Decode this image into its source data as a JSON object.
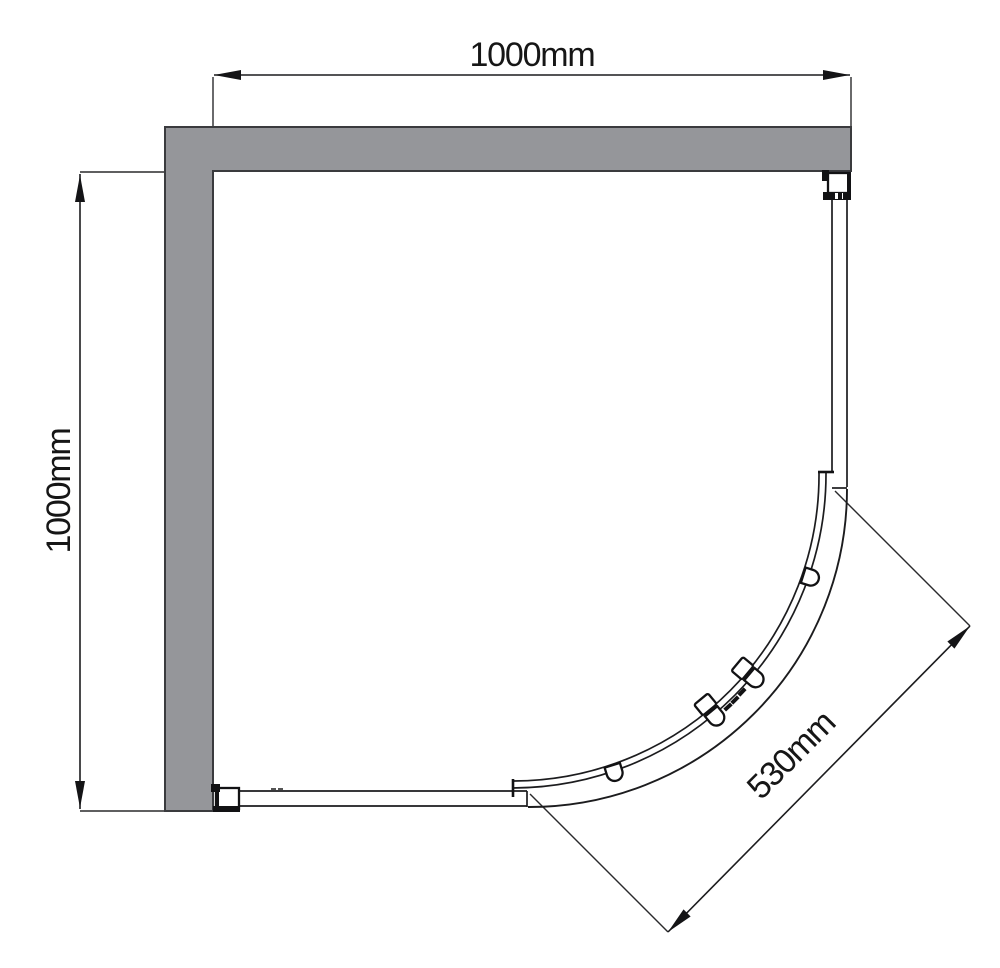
{
  "drawing": {
    "dim_top_label": "1000mm",
    "dim_left_label": "1000mm",
    "dim_diag_label": "530mm"
  },
  "colors": {
    "background": "#ffffff",
    "wall_fill": "#95969A",
    "wall_stroke": "#3A3B3E",
    "line": "#1C1C1E"
  }
}
